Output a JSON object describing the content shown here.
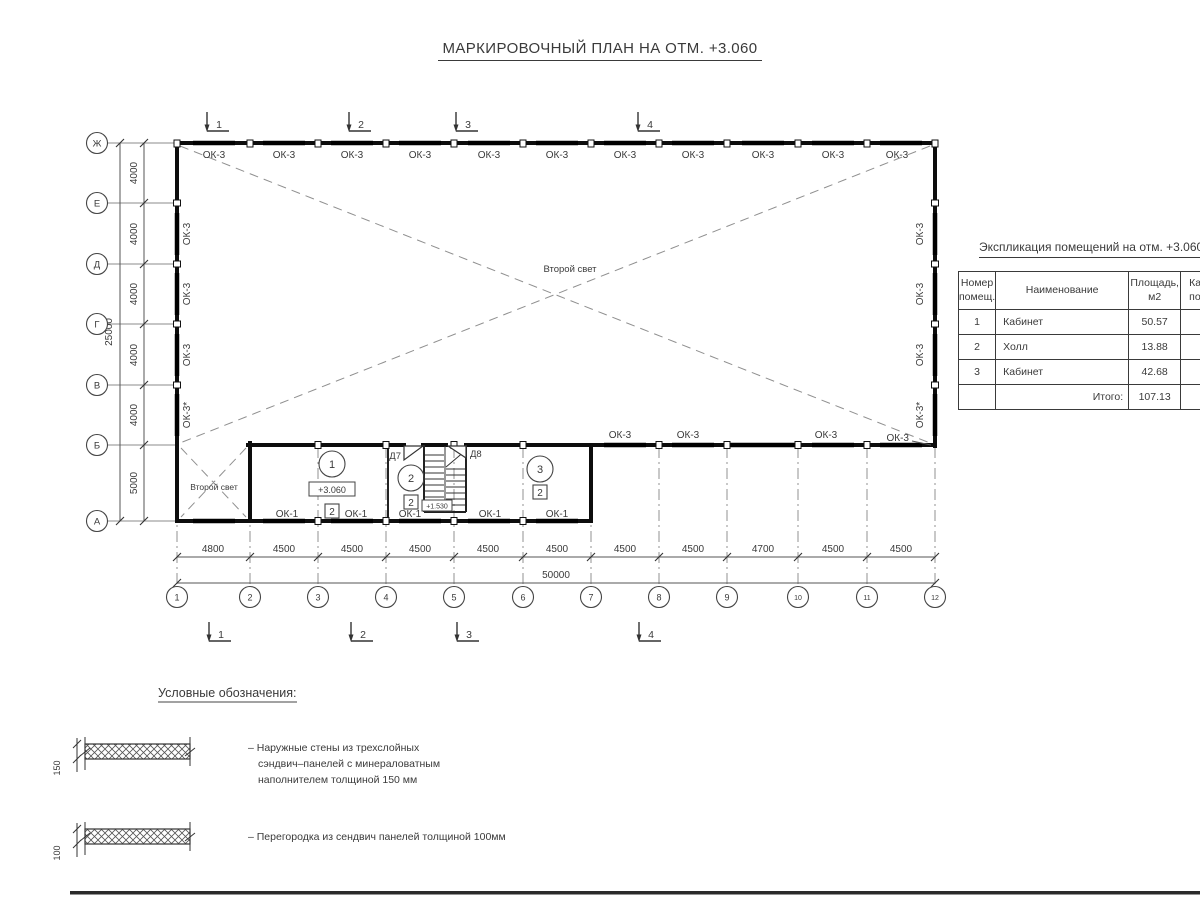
{
  "title": "МАРКИРОВОЧНЫЙ ПЛАН НА ОТМ. +3.060",
  "colors": {
    "ink": "#3a3a3a",
    "wall": "#0d0d0d"
  },
  "plan": {
    "void_label": "Второй свет",
    "elevation_mark": "+3.060",
    "stair_elevation": "+1.530",
    "marks": {
      "ok3": "ОК-3",
      "ok3_star": "ОК-3*",
      "ok1": "ОК-1"
    },
    "doors": {
      "d7": "Д7",
      "d8": "Д8"
    },
    "rooms": [
      {
        "num": "1",
        "cat": "2"
      },
      {
        "num": "2",
        "cat": "2"
      },
      {
        "num": "3",
        "cat": "2"
      }
    ],
    "sections": [
      "1",
      "2",
      "3",
      "4"
    ]
  },
  "axes": {
    "rows": [
      "Ж",
      "Е",
      "Д",
      "Г",
      "В",
      "Б",
      "А"
    ],
    "cols": [
      "1",
      "2",
      "3",
      "4",
      "5",
      "6",
      "7",
      "8",
      "9",
      "10",
      "11",
      "12"
    ]
  },
  "dims": {
    "left_segments": [
      "4000",
      "4000",
      "4000",
      "4000",
      "4000",
      "5000"
    ],
    "left_total": "25000",
    "bottom_segments": [
      "4800",
      "4500",
      "4500",
      "4500",
      "4500",
      "4500",
      "4500",
      "4500",
      "4700",
      "4500",
      "4500"
    ],
    "bottom_total": "50000"
  },
  "table": {
    "title": "Экспликация помещений на отм. +3.060",
    "headers": {
      "col1_line1": "Номер",
      "col1_line2": "помещ.",
      "col2": "Наименование",
      "col3_line1": "Площадь,",
      "col3_line2": "м2",
      "col4_line1": "Ка",
      "col4_line2": "по"
    },
    "rows": [
      {
        "num": "1",
        "name": "Кабинет",
        "area": "50.57"
      },
      {
        "num": "2",
        "name": "Холл",
        "area": "13.88"
      },
      {
        "num": "3",
        "name": "Кабинет",
        "area": "42.68"
      }
    ],
    "total_label": "Итого:",
    "total_value": "107.13"
  },
  "legend": {
    "title": "Условные обозначения:",
    "items": [
      {
        "thickness": "150",
        "lines": [
          "– Наружные стены из трехслойных",
          "сэндвич–панелей с минераловатным",
          "наполнителем толщиной 150 мм"
        ]
      },
      {
        "thickness": "100",
        "lines": [
          "– Перегородка из сендвич панелей толщиной 100мм"
        ]
      }
    ]
  }
}
